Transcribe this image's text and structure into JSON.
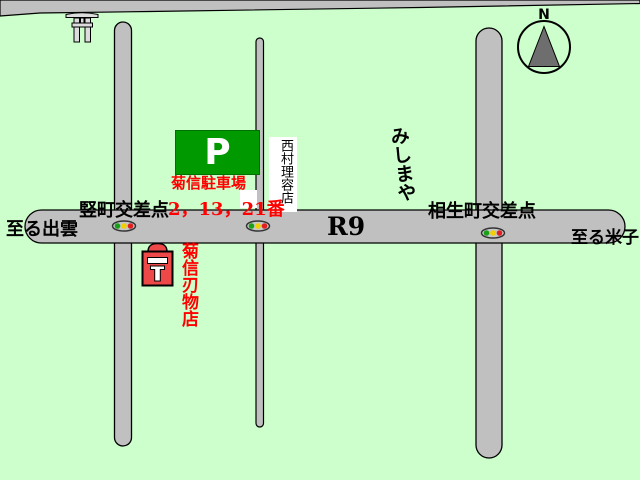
{
  "map": {
    "labels": {
      "to_izumo": "至る出雲",
      "tatemachi_crossing": "竪町交差点",
      "bus_stops": "2，13，21番",
      "route_r9": "R9",
      "aioicho_crossing": "相生町交差点",
      "to_yonago": "至る米子",
      "parking_letter": "P",
      "parking_name": "菊信駐車場",
      "barber_shop": "西村理容店",
      "mishimaya": "みしまや",
      "knife_shop": "菊信刃物店",
      "compass_north": "N"
    },
    "colors": {
      "background": "#CCFFCC",
      "road": "#C0C0C0",
      "parking_sign_green": "#009900",
      "label_red": "#FF0000",
      "shop_marker_red": "#EE4848",
      "signal_green": "#18A018",
      "signal_yellow": "#F0D000",
      "signal_red": "#E02020",
      "compass_needle_gray": "#6E6E6E"
    },
    "icons": [
      "torii-gate-icon",
      "compass-icon",
      "traffic-light-icon",
      "shop-marker-icon",
      "parking-sign"
    ]
  }
}
